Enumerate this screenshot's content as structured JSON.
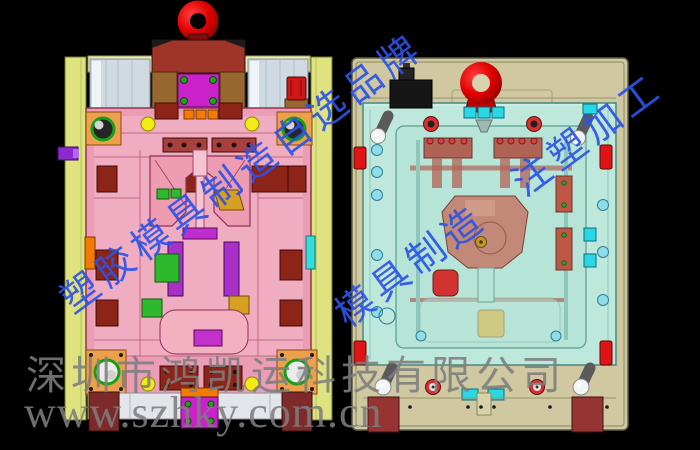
{
  "watermarks": {
    "diagonal_left": "塑胶模具制造自选品牌",
    "diagonal_right": "模具制造　注塑加工",
    "company_line": "深圳市鸿凯运科技有限公司",
    "website_line": "www.szhky.com.cn",
    "diagonal_color": "#2d52e6",
    "gray_color": "#7d7d7d"
  },
  "colors": {
    "background": "#000000",
    "left_mold": {
      "side_plate": "#dee37f",
      "main_plate": "#ec9db6",
      "plate_light": "#f4b6c7",
      "lift_ring": "#e30000",
      "top_clamp": "#9e3528",
      "pillar": "#96672e",
      "magenta_block": "#cb21cb",
      "purple_slide": "#a830c8",
      "screw_pad": "#8c2418",
      "corner_pad": "#eda04c",
      "bushing_ring": "#17a017",
      "yellow_dot": "#f3eb14",
      "orange": "#f57a00",
      "green_block": "#2db82d",
      "gold": "#d8a020",
      "cyan_bar": "#35dcdc",
      "foot": "#7e2a2a"
    },
    "right_mold": {
      "back_plate": "#cfc8a1",
      "cavity_plate": "#bfe8dc",
      "inner_plate": "#b6e5d7",
      "lift_ring": "#e20000",
      "bracket": "#161616",
      "detail_red_brown": "#b05448",
      "core": "#c47f6e",
      "water_circle": "#8fdcea",
      "cyan_tab": "#28d8e4",
      "grommet": "#d83030",
      "gold_block": "#e8a818",
      "red_edge_block": "#e01414",
      "fitting_ball": "#f4f4f4",
      "foot": "#963434"
    }
  }
}
